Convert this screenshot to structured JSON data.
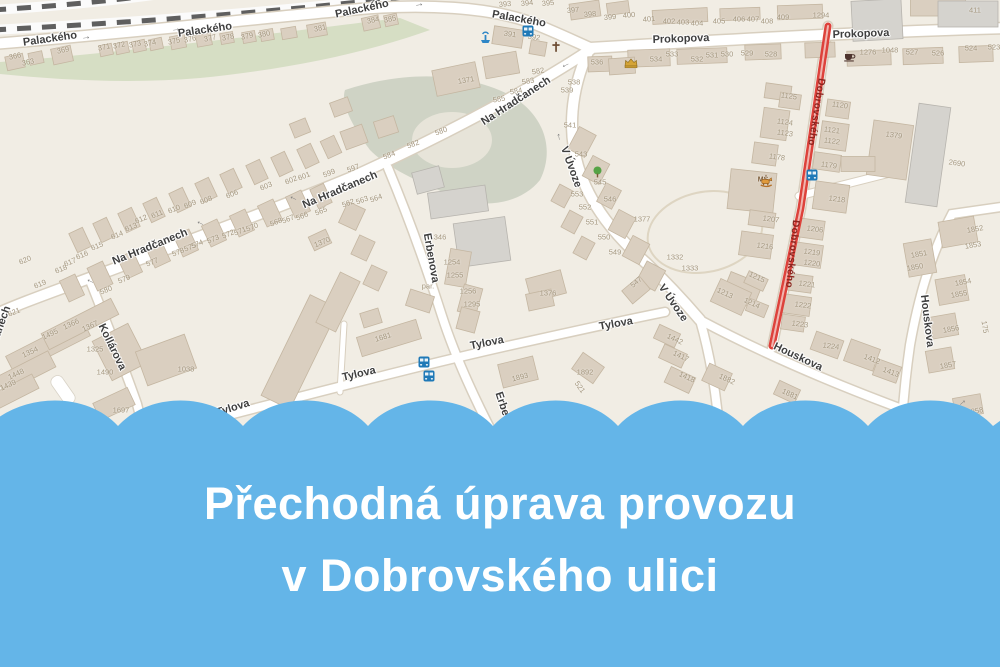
{
  "banner": {
    "line1": "Přechodná úprava provozu",
    "line2": "v Dobrovského ulici"
  },
  "colors": {
    "banner_blue": "#64b5e8",
    "map_bg": "#f1ede4",
    "road_fill": "#ffffff",
    "road_casing": "#d8cfbf",
    "building_fill": "#dacfc0",
    "building_stroke": "#c4b6a1",
    "gray_building_fill": "#d5d3ce",
    "gray_building_stroke": "#b7b4ae",
    "green_area": "#ccd8ba",
    "cliff_area": "#c9cec0",
    "rail_dark": "#5f5f5f",
    "closure_red": "#dd423b",
    "closure_text": "#8c251f",
    "street_text": "#3f3f3f",
    "number_text": "#a4977f",
    "bus_blue": "#1f79b7",
    "water_blue": "#2e86c6",
    "poi_brown": "#6d4c33",
    "poi_gold": "#d4a437",
    "poi_green": "#55a345",
    "poi_orange": "#e09a3c"
  },
  "map": {
    "closed_street_name": "Dobrovského",
    "street_labels": [
      {
        "t": "Palackého",
        "x": 50,
        "y": 39,
        "r": -8
      },
      {
        "t": "Palackého",
        "x": 205,
        "y": 30,
        "r": -8
      },
      {
        "t": "Palackého",
        "x": 362,
        "y": 9,
        "r": -12
      },
      {
        "t": "Palackého",
        "x": 519,
        "y": 19,
        "r": 10
      },
      {
        "t": "Prokopova",
        "x": 681,
        "y": 39,
        "r": -2
      },
      {
        "t": "Prokopova",
        "x": 861,
        "y": 34,
        "r": -2
      },
      {
        "t": "Na Hradčanech",
        "x": 516,
        "y": 101,
        "r": -33
      },
      {
        "t": "Na Hradčanech",
        "x": 340,
        "y": 190,
        "r": -23
      },
      {
        "t": "Na Hradčanech",
        "x": 150,
        "y": 247,
        "r": -22
      },
      {
        "t": "Na Hradčanech",
        "x": -6,
        "y": 344,
        "r": -70
      },
      {
        "t": "Kollárova",
        "x": 112,
        "y": 347,
        "r": 64
      },
      {
        "t": "Erbenova",
        "x": 431,
        "y": 258,
        "r": 80
      },
      {
        "t": "Erbenova",
        "x": 506,
        "y": 416,
        "r": 72
      },
      {
        "t": "V Úvoze",
        "x": 571,
        "y": 167,
        "r": 70
      },
      {
        "t": "V Úvoze",
        "x": 673,
        "y": 303,
        "r": 55
      },
      {
        "t": "Tylova",
        "x": 233,
        "y": 408,
        "r": -17
      },
      {
        "t": "Tylova",
        "x": 359,
        "y": 374,
        "r": -13
      },
      {
        "t": "Tylova",
        "x": 487,
        "y": 343,
        "r": -11
      },
      {
        "t": "Tylova",
        "x": 616,
        "y": 324,
        "r": -10
      },
      {
        "t": "Houskova",
        "x": 798,
        "y": 357,
        "r": 25
      },
      {
        "t": "Houskova",
        "x": 927,
        "y": 321,
        "r": 83
      },
      {
        "t": "Dobrovského",
        "x": 816,
        "y": 112,
        "r": 99,
        "c": 1
      },
      {
        "t": "Dobrovského",
        "x": 792,
        "y": 254,
        "r": 96,
        "c": 1
      }
    ],
    "house_numbers": [
      [
        "366",
        15,
        56,
        -12
      ],
      [
        "363",
        28,
        62,
        -12
      ],
      [
        "369",
        63,
        50,
        -12
      ],
      [
        "371",
        104,
        47,
        -12
      ],
      [
        "372",
        119,
        45,
        -12
      ],
      [
        "373",
        135,
        44,
        -12
      ],
      [
        "374",
        150,
        43,
        -12
      ],
      [
        "375",
        174,
        41,
        -12
      ],
      [
        "376",
        190,
        39,
        -12
      ],
      [
        "377",
        210,
        38,
        -12
      ],
      [
        "378",
        228,
        37,
        -12
      ],
      [
        "379",
        247,
        36,
        -12
      ],
      [
        "380",
        264,
        34,
        -12
      ],
      [
        "381",
        320,
        28,
        -12
      ],
      [
        "384",
        373,
        20,
        -12
      ],
      [
        "385",
        390,
        19,
        -12
      ],
      [
        "391",
        510,
        34,
        8
      ],
      [
        "392",
        534,
        37,
        8
      ],
      [
        "393",
        505,
        4,
        -5
      ],
      [
        "394",
        527,
        3,
        -5
      ],
      [
        "395",
        548,
        3,
        -5
      ],
      [
        "397",
        573,
        10,
        -5
      ],
      [
        "398",
        590,
        14,
        -5
      ],
      [
        "399",
        610,
        17,
        -5
      ],
      [
        "400",
        629,
        15,
        -5
      ],
      [
        "401",
        649,
        19,
        -5
      ],
      [
        "402",
        669,
        21,
        0
      ],
      [
        "403",
        683,
        22,
        0
      ],
      [
        "404",
        697,
        23,
        0
      ],
      [
        "405",
        719,
        21,
        0
      ],
      [
        "406",
        739,
        19,
        0
      ],
      [
        "407",
        753,
        19,
        0
      ],
      [
        "408",
        767,
        21,
        0
      ],
      [
        "409",
        783,
        17,
        0
      ],
      [
        "1294",
        821,
        15,
        0
      ],
      [
        "411",
        975,
        10,
        0
      ],
      [
        "536",
        597,
        62,
        0
      ],
      [
        "538",
        574,
        82,
        0
      ],
      [
        "539",
        567,
        90,
        0
      ],
      [
        "534",
        656,
        59,
        0
      ],
      [
        "533",
        672,
        54,
        0
      ],
      [
        "532",
        697,
        59,
        0
      ],
      [
        "531",
        712,
        55,
        0
      ],
      [
        "530",
        727,
        54,
        0
      ],
      [
        "529",
        747,
        53,
        0
      ],
      [
        "528",
        771,
        54,
        0
      ],
      [
        "1276",
        868,
        52,
        0
      ],
      [
        "1048",
        890,
        50,
        0
      ],
      [
        "527",
        912,
        52,
        0
      ],
      [
        "526",
        938,
        53,
        0
      ],
      [
        "524",
        971,
        48,
        0
      ],
      [
        "523",
        994,
        47,
        0
      ],
      [
        "582",
        538,
        71,
        -10
      ],
      [
        "583",
        528,
        81,
        -10
      ],
      [
        "584",
        516,
        91,
        -10
      ],
      [
        "585",
        499,
        99,
        -10
      ],
      [
        "599",
        329,
        173,
        -22
      ],
      [
        "601",
        304,
        176,
        -22
      ],
      [
        "602",
        291,
        180,
        -22
      ],
      [
        "603",
        266,
        186,
        -22
      ],
      [
        "606",
        232,
        194,
        -22
      ],
      [
        "608",
        206,
        200,
        -22
      ],
      [
        "609",
        190,
        204,
        -22
      ],
      [
        "610",
        174,
        209,
        -22
      ],
      [
        "611",
        157,
        214,
        -22
      ],
      [
        "612",
        141,
        219,
        -22
      ],
      [
        "613",
        131,
        227,
        -22
      ],
      [
        "614",
        117,
        235,
        -22
      ],
      [
        "615",
        97,
        246,
        -22
      ],
      [
        "616",
        82,
        255,
        -22
      ],
      [
        "617",
        70,
        262,
        -22
      ],
      [
        "618",
        61,
        269,
        -22
      ],
      [
        "619",
        40,
        284,
        -22
      ],
      [
        "620",
        25,
        260,
        -22
      ],
      [
        "621",
        14,
        312,
        -22
      ],
      [
        "565",
        321,
        211,
        -22
      ],
      [
        "566",
        302,
        216,
        -22
      ],
      [
        "567",
        288,
        219,
        -22
      ],
      [
        "568",
        276,
        222,
        -22
      ],
      [
        "570",
        252,
        227,
        -22
      ],
      [
        "571",
        240,
        231,
        -22
      ],
      [
        "572",
        228,
        234,
        -22
      ],
      [
        "573",
        213,
        239,
        -22
      ],
      [
        "574",
        197,
        244,
        -22
      ],
      [
        "575",
        190,
        247,
        -22
      ],
      [
        "1370",
        322,
        242,
        -22
      ],
      [
        "577",
        152,
        262,
        -22
      ],
      [
        "578",
        178,
        252,
        -22
      ],
      [
        "579",
        124,
        279,
        -22
      ],
      [
        "580",
        106,
        290,
        -22
      ],
      [
        "580",
        441,
        131,
        -20
      ],
      [
        "582",
        413,
        144,
        -20
      ],
      [
        "584",
        389,
        155,
        -20
      ],
      [
        "597",
        353,
        168,
        -20
      ],
      [
        "562",
        348,
        203,
        -20
      ],
      [
        "563",
        362,
        200,
        -20
      ],
      [
        "564",
        376,
        198,
        -20
      ],
      [
        "1366",
        71,
        324,
        -25
      ],
      [
        "1367",
        90,
        326,
        -25
      ],
      [
        "1495",
        50,
        334,
        -25
      ],
      [
        "1354",
        30,
        352,
        -25
      ],
      [
        "1448",
        16,
        374,
        -25
      ],
      [
        "1439",
        8,
        385,
        -25
      ],
      [
        "1325",
        95,
        349,
        0
      ],
      [
        "1490",
        105,
        372,
        0
      ],
      [
        "1038",
        186,
        369,
        0
      ],
      [
        "1697",
        121,
        410,
        0
      ],
      [
        "1681",
        383,
        337,
        -17
      ],
      [
        "1893",
        520,
        377,
        -14
      ],
      [
        "1892",
        585,
        372,
        0
      ],
      [
        "521",
        580,
        387,
        55
      ],
      [
        "1371",
        466,
        80,
        -10
      ],
      [
        "346",
        440,
        237,
        0
      ],
      [
        "541",
        570,
        125,
        0
      ],
      [
        "543",
        581,
        154,
        0
      ],
      [
        "545",
        600,
        182,
        0
      ],
      [
        "546",
        610,
        199,
        0
      ],
      [
        "1377",
        642,
        219,
        0
      ],
      [
        "553",
        577,
        194,
        0
      ],
      [
        "552",
        585,
        207,
        0
      ],
      [
        "551",
        592,
        222,
        0
      ],
      [
        "550",
        604,
        237,
        0
      ],
      [
        "549",
        615,
        252,
        0
      ],
      [
        "547",
        636,
        282,
        -40
      ],
      [
        "1376",
        548,
        293,
        0
      ],
      [
        "1254",
        452,
        262,
        0
      ],
      [
        "1255",
        455,
        275,
        0
      ],
      [
        "1256",
        468,
        291,
        0
      ],
      [
        "1295",
        472,
        304,
        0
      ],
      [
        "par.",
        428,
        286,
        0
      ],
      [
        "1125",
        789,
        96,
        8
      ],
      [
        "1120",
        840,
        105,
        8
      ],
      [
        "1124",
        785,
        122,
        8
      ],
      [
        "1123",
        785,
        133,
        8
      ],
      [
        "1121",
        832,
        130,
        8
      ],
      [
        "1122",
        832,
        141,
        8
      ],
      [
        "1178",
        777,
        157,
        8
      ],
      [
        "1179",
        829,
        165,
        8
      ],
      [
        "1379",
        894,
        135,
        8
      ],
      [
        "2690",
        957,
        163,
        8
      ],
      [
        "1218",
        837,
        199,
        8
      ],
      [
        "1207",
        771,
        219,
        8
      ],
      [
        "1206",
        815,
        229,
        8
      ],
      [
        "1216",
        765,
        246,
        8
      ],
      [
        "1219",
        812,
        252,
        8
      ],
      [
        "1220",
        812,
        263,
        8
      ],
      [
        "1221",
        807,
        284,
        8
      ],
      [
        "1222",
        803,
        305,
        8
      ],
      [
        "1223",
        800,
        324,
        8
      ],
      [
        "1224",
        831,
        346,
        8
      ],
      [
        "1215",
        757,
        277,
        25
      ],
      [
        "1213",
        725,
        293,
        25
      ],
      [
        "1214",
        752,
        303,
        25
      ],
      [
        "1412",
        872,
        359,
        20
      ],
      [
        "1413",
        891,
        372,
        20
      ],
      [
        "1442",
        675,
        339,
        25
      ],
      [
        "1417",
        681,
        356,
        25
      ],
      [
        "1418",
        687,
        377,
        25
      ],
      [
        "1882",
        727,
        379,
        25
      ],
      [
        "1881",
        790,
        394,
        25
      ],
      [
        "1332",
        675,
        257,
        0
      ],
      [
        "1333",
        690,
        268,
        0
      ],
      [
        "1852",
        975,
        229,
        -10
      ],
      [
        "1853",
        973,
        245,
        -10
      ],
      [
        "1851",
        919,
        254,
        -10
      ],
      [
        "1850",
        915,
        267,
        -10
      ],
      [
        "1854",
        963,
        282,
        -10
      ],
      [
        "1855",
        959,
        294,
        -10
      ],
      [
        "1856",
        951,
        329,
        -10
      ],
      [
        "1857",
        948,
        365,
        -10
      ],
      [
        "1858",
        975,
        411,
        -10
      ],
      [
        "175",
        985,
        327,
        80
      ]
    ],
    "poi_icons": [
      {
        "k": "fountain",
        "x": 479,
        "y": 31
      },
      {
        "k": "bus",
        "x": 522,
        "y": 25
      },
      {
        "k": "church",
        "x": 551,
        "y": 41
      },
      {
        "k": "castle",
        "x": 624,
        "y": 57
      },
      {
        "k": "cafe",
        "x": 843,
        "y": 50
      },
      {
        "k": "tree",
        "x": 592,
        "y": 166
      },
      {
        "k": "school",
        "x": 763,
        "y": 180,
        "l": "MŠ"
      },
      {
        "k": "bus",
        "x": 806,
        "y": 169
      },
      {
        "k": "bus",
        "x": 418,
        "y": 356
      },
      {
        "k": "bus",
        "x": 423,
        "y": 370
      }
    ],
    "oneway_arrows": [
      [
        86,
        37,
        -8
      ],
      [
        176,
        29,
        -8
      ],
      [
        419,
        4,
        -10
      ],
      [
        566,
        66,
        155
      ],
      [
        293,
        199,
        205
      ],
      [
        200,
        224,
        205
      ],
      [
        90,
        282,
        205
      ],
      [
        558,
        137,
        -100
      ],
      [
        962,
        402,
        -40
      ]
    ]
  }
}
